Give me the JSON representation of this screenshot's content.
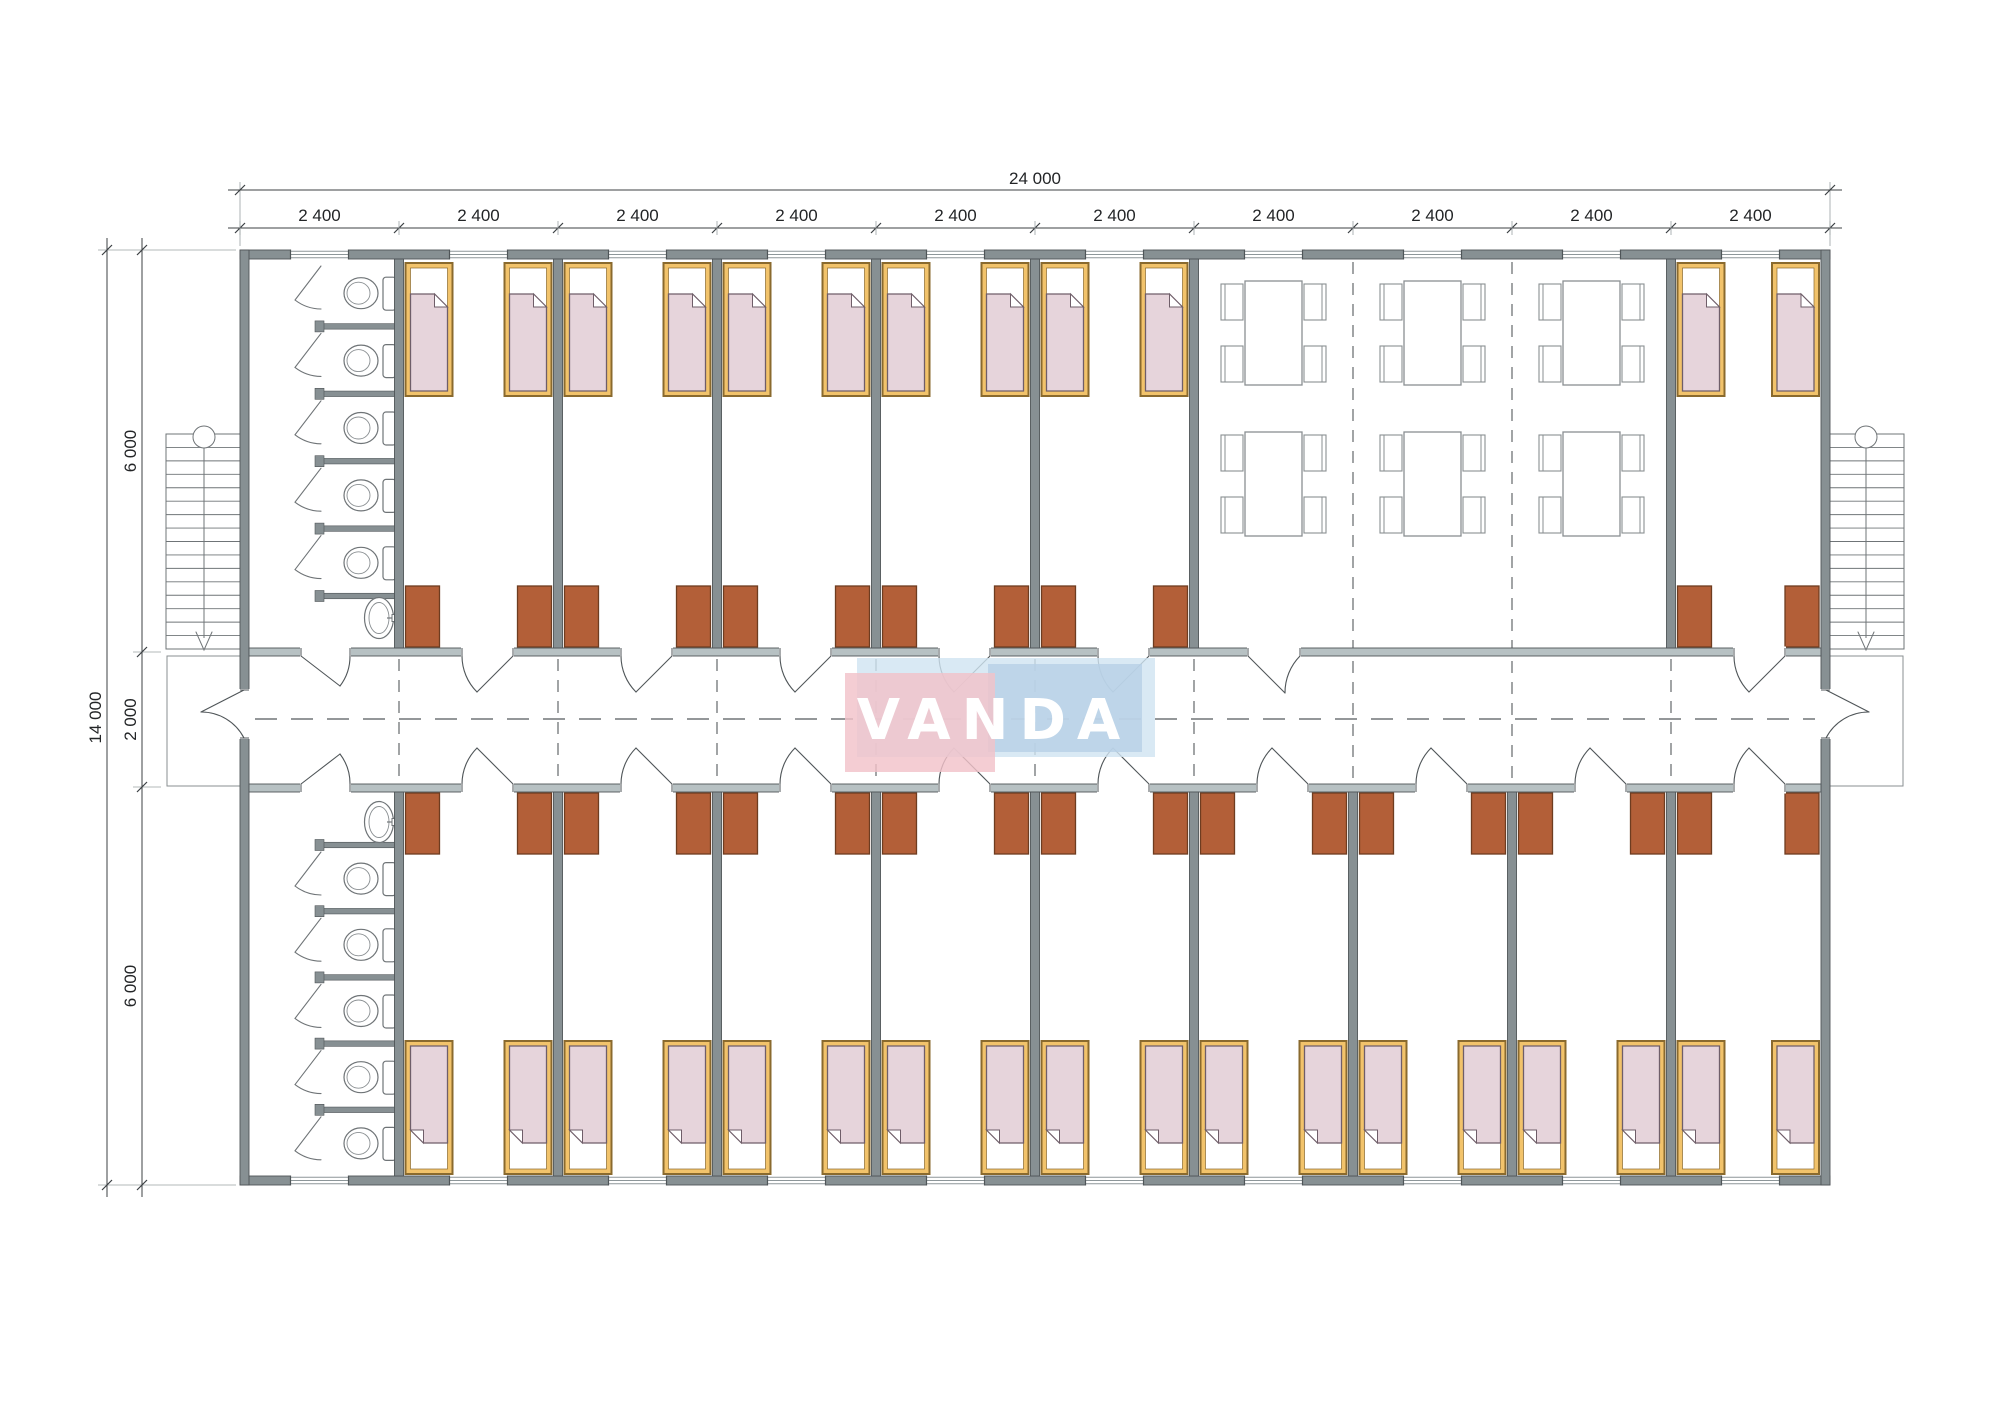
{
  "watermark": {
    "text": "VANDA"
  },
  "dimensions": {
    "overall_width": "24 000",
    "module_widths": [
      "2 400",
      "2 400",
      "2 400",
      "2 400",
      "2 400",
      "2 400",
      "2 400",
      "2 400",
      "2 400",
      "2 400"
    ],
    "overall_height": "14 000",
    "height_segments": [
      "6 000",
      "2 000",
      "6 000"
    ]
  },
  "plan": {
    "module_count": 10,
    "top_modules": [
      "bathroom",
      "bedroom",
      "bedroom",
      "bedroom",
      "bedroom",
      "bedroom",
      "dining",
      "dining",
      "dining",
      "bedroom"
    ],
    "bottom_modules": [
      "bathroom",
      "bedroom",
      "bedroom",
      "bedroom",
      "bedroom",
      "bedroom",
      "bedroom",
      "bedroom",
      "bedroom",
      "bedroom"
    ],
    "bathroom": {
      "toilet_stalls": 5,
      "sinks": 1
    },
    "bedroom": {
      "beds": 2,
      "wardrobes": 2
    },
    "dining": {
      "tables": 6,
      "chairs_per_table": 4
    },
    "stairs": {
      "left": 1,
      "right": 1,
      "treads": 15
    }
  },
  "colors": {
    "wall_fill": "#879093",
    "wall_edge": "#4f5558",
    "corridor_wall_fill": "#b7c1c3",
    "bed_frame": "#f2c36b",
    "bed_frame_edge": "#8a6a2e",
    "blanket": "#e6d4db",
    "blanket_edge": "#6f5e69",
    "wardrobe": "#b35f38",
    "wardrobe_edge": "#6e3c20",
    "fixture_line": "#6f7477",
    "furniture_line": "#8a8f92",
    "dash_line": "#55595c",
    "dim_line": "#3c4043",
    "dim_text": "#232527",
    "ext_line": "#9aa0a3",
    "logo_pink": "#f2c2c9",
    "logo_blue": "#cfe3f1",
    "logo_blue_dark": "#b7cfe6",
    "logo_text": "#ffffff"
  }
}
